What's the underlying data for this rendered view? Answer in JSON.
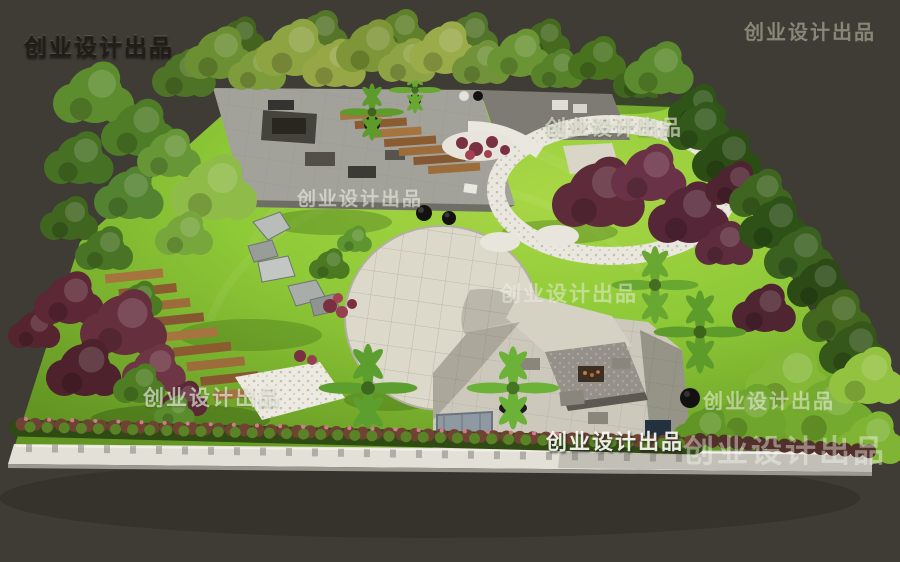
{
  "image": {
    "kind": "3d-landscape-render",
    "description": "Aerial 3D rendering of a square courtyard garden: tree-lined paved patio at top-left, central circular paved plaza, circular lawn with white pebble ring and purple-leaf trees at right, stone fire-pit pavilion on lower pavement, wooden plank paths, boulders, flowering hedge and white perimeter wall along the bottom, dense mixed trees on left and right edges, all on a dark gray backdrop",
    "width_px": 900,
    "height_px": 562
  },
  "watermark": {
    "text": "创业设计出品"
  },
  "palette": {
    "background": "#3f3b35",
    "lawn": "#8ec937",
    "lawn_light": "#abdc4a",
    "lawn_shadow": "#55841f",
    "plaza_pavement": "#dcd8ca",
    "patio_pavement": "#a3a29a",
    "pebble": "#eae8de",
    "wood_plank": "#a5743f",
    "purple_foliage": "#5e2b3a",
    "green_foliage": "#4e7c22",
    "bright_hedge": "#86b838",
    "wall": "#e3e0d7",
    "fire_pit": "#3b2f24",
    "dark_planter": "#17150f"
  },
  "scene_areas": [
    {
      "name": "top-tree-row",
      "label": "row of tall trees along top edge"
    },
    {
      "name": "patio",
      "label": "paved patio with sunken seating and planters"
    },
    {
      "name": "plank-steps",
      "label": "wooden plank steps"
    },
    {
      "name": "central-plaza",
      "label": "circular paved plaza"
    },
    {
      "name": "pebble-ring-lawn",
      "label": "circular lawn ringed by white pebble path"
    },
    {
      "name": "purple-trees",
      "label": "purple-leaf ornamental trees"
    },
    {
      "name": "boulder-garden",
      "label": "scattered gray boulders on lawn"
    },
    {
      "name": "fire-pit-pavilion",
      "label": "stone fire-pit table with benches"
    },
    {
      "name": "perimeter-hedge",
      "label": "flowering hedge row"
    },
    {
      "name": "perimeter-wall",
      "label": "white boundary wall"
    }
  ]
}
